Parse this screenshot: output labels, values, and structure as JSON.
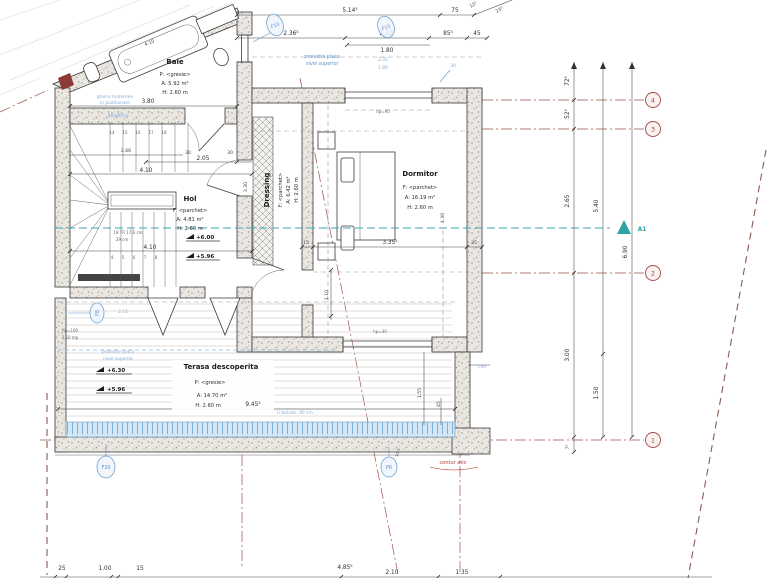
{
  "rooms": {
    "baie": {
      "name": "Baie",
      "finish": "P: <gresie>",
      "area": "A: 5.92 m²",
      "height": "H: 2.60 m"
    },
    "hol": {
      "name": "Hol",
      "finish": "F: <parchet>",
      "area": "A: 4.81 m²",
      "height": "H: 2.60 m",
      "level_upper": "+6.00",
      "level_lower": "+5.96"
    },
    "dressing": {
      "name": "Dressing",
      "finish": "F: <parchet>",
      "area": "A: 6.42 m²",
      "height": "H: 2.60 m"
    },
    "dormitor": {
      "name": "Dormitor",
      "finish": "F: <parchet>",
      "area": "A: 16.19 m²",
      "height": "H: 2.60 m"
    },
    "terasa": {
      "name": "Terasa descoperita",
      "finish": "P: <gresie>",
      "area": "A: 14.70 m²",
      "height": "H: 2.60 m",
      "level_upper": "+6.30",
      "level_lower": "+5.96",
      "width_dim": "9.45⁵"
    }
  },
  "grid_markers": [
    "4",
    "3",
    "2",
    "1"
  ],
  "section_marker": "A1",
  "window_tags": {
    "f10": "F10",
    "f15": "F15",
    "f20": "F20",
    "f8": "F8",
    "p6": "P6"
  },
  "dims_top": {
    "d1": "5.14⁵",
    "d2": "75",
    "d3": "12⁵",
    "d4": "23⁵",
    "d5": "2.36⁵",
    "d6": "2.32",
    "d7": "1.80",
    "d8": "85⁵",
    "d9": "45"
  },
  "dims_right": {
    "d1": "72⁵",
    "d2": "52⁵",
    "d3": "2.65",
    "d4": "3.00",
    "d5": "7⁵",
    "d6": "5.40",
    "d7": "1.50",
    "d8": "6.90"
  },
  "dims_bottom": {
    "d1": "25",
    "d2": "1.00",
    "d3": "15",
    "d4": "4.85⁵",
    "d5": "2.10",
    "d6": "1.35"
  },
  "dims_plan": {
    "d1": "3.80",
    "d2": "2.66",
    "d3": "30",
    "d4": "2.05",
    "d5": "30",
    "d6": "4.10",
    "d7": "4.10",
    "d8": "4.10",
    "d9": "3.30",
    "d10": "3.35⁵",
    "d11": "15",
    "d12": "35",
    "d13": "1.10",
    "d14": "4.30",
    "d15": "1.55",
    "d16": "45",
    "d17": "10,5",
    "d18": "2.15"
  },
  "annotations": {
    "slab1": "proiectie placa",
    "slab2": "nivel superior",
    "ghena1": "ghena materiale",
    "ghena2": "in pozitionare",
    "ghena3": "80x80cm",
    "stair1": "18 TR 17,6 cm",
    "stair2": "29 cm",
    "hp90": "hp=90",
    "hp30": "hp=30",
    "hp100": "hp=100",
    "mp": "2.50 mp",
    "balustrade": "h balustr. 90 cm",
    "contur": "contur atic",
    "blue30": "30",
    "blue232": "2.32",
    "blue180": "1.80",
    "ihe": "i.he"
  },
  "stair_numbers": {
    "top": [
      "14",
      "15",
      "16",
      "17",
      "18"
    ],
    "bottom": [
      "4",
      "5",
      "6",
      "7",
      "8"
    ]
  },
  "colors": {
    "grid": "#a04a42",
    "blue": "#5d93c9",
    "teal": "#2fa3a3",
    "red": "#b03a2e"
  }
}
